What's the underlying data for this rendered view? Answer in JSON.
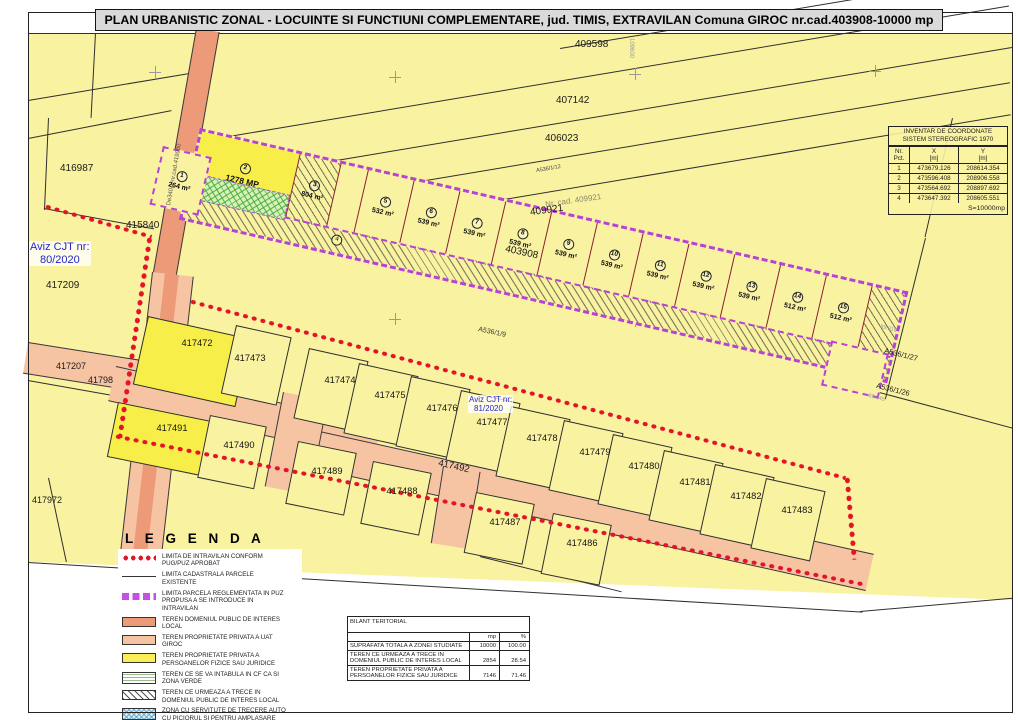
{
  "title": "PLAN URBANISTIC ZONAL - LOCUINTE SI FUNCTIUNI COMPLEMENTARE,  jud. TIMIS, EXTRAVILAN Comuna GIROC  nr.cad.403908-10000 mp",
  "coord_table": {
    "title1": "INVENTAR DE COORDONATE",
    "title2": "SISTEM STEREOGRAFIC 1970",
    "h_nr": "Nr. Pct.",
    "h_x": "X",
    "h_y": "Y",
    "unit": "[m]",
    "rows": [
      {
        "n": "1",
        "x": "473679.126",
        "y": "208614.354"
      },
      {
        "n": "2",
        "x": "473596.408",
        "y": "208906.558"
      },
      {
        "n": "3",
        "x": "473564.692",
        "y": "208897.692"
      },
      {
        "n": "4",
        "x": "473647.392",
        "y": "208605.551"
      }
    ],
    "footer": "S=10000mp"
  },
  "legend": {
    "title": "L E G E N D A",
    "items": [
      "LIMITA DE INTRAVILAN CONFORM PUG/PUZ APROBAT",
      "LIMITA CADASTRALA PARCELE EXISTENTE",
      "LIMITA PARCELA REGLEMENTATA IN PUZ PROPUSA A SE INTRODUCE IN INTRAVILAN",
      "TEREN DOMENIUL PUBLIC DE INTERES LOCAL",
      "TEREN PROPRIETATE PRIVATA A UAT GIROC",
      "TEREN PROPRIETATE PRIVATA A PERSOANELOR FIZICE SAU JURIDICE",
      "TEREN CE SE VA INTABULA IN CF CA SI ZONA VERDE",
      "TEREN CE URMEAZA A TRECE IN DOMENIUL PUBLIC DE INTERES LOCAL",
      "ZONA CU SERVITUTE DE TRECERE AUTO CU PICIORUL SI PENTRU AMPLASARE RETELE UTILITATI IN FAVOAREA PROPRIETARILOR PARCELELOR 5-14, PANA LA REALIZAREA CONTINUITATII DRUMURILOR PUBLICE"
    ]
  },
  "bilant": {
    "title": "BILANT TERITORIAL",
    "col_mp": "mp",
    "col_pct": "%",
    "rows": [
      {
        "label": "SUPRAFATA TOTALA A ZONEI STUDIATE",
        "mp": "10000",
        "pct": "100.00"
      },
      {
        "label": "TEREN CE URMEAZA A TRECE IN DOMENIUL PUBLIC DE INTERES LOCAL",
        "mp": "2854",
        "pct": "28.54"
      },
      {
        "label": "TEREN PROPRIETATE PRIVATA A PERSOANELOR FIZICE SAU JURIDICE",
        "mp": "7146",
        "pct": "71.46"
      }
    ]
  },
  "strip": {
    "parcels": [
      {
        "n": "1",
        "area": "264 m²"
      },
      {
        "n": "2",
        "area": "1278 MP"
      },
      {
        "n": "3",
        "area": "804 m²"
      },
      {
        "n": "4",
        "area": ""
      },
      {
        "n": "5",
        "area": "532 m²"
      },
      {
        "n": "6",
        "area": "539 m²"
      },
      {
        "n": "7",
        "area": "539 m²"
      },
      {
        "n": "8",
        "area": "539 m²"
      },
      {
        "n": "9",
        "area": "539 m²"
      },
      {
        "n": "10",
        "area": "539 m²"
      },
      {
        "n": "11",
        "area": "539 m²"
      },
      {
        "n": "12",
        "area": "539 m²"
      },
      {
        "n": "13",
        "area": "539 m²"
      },
      {
        "n": "14",
        "area": "512 m²"
      },
      {
        "n": "15",
        "area": "512 m²"
      }
    ]
  },
  "map_labels": {
    "p409598": "409598",
    "p407142": "407142",
    "p406023": "406023",
    "a536_1_12": "A536/1/12",
    "cad409921": "Nr. cad. 409921",
    "p409921": "409921",
    "grid": "109600",
    "cad403908": "403908",
    "a536_1_9": "A536/1/9",
    "a536_1_27": "A536/1/27",
    "a536_1_26": "A536/1/26",
    "dim1": "89.919",
    "dim2": "89.845",
    "p416987": "416987",
    "p415840": "415840",
    "p417209": "417209",
    "p417207": "417207",
    "p41798": "41798",
    "p417972": "417972",
    "road_de": "De340/1-nr.cad.419080",
    "road_492": "417492",
    "aviz80_1": "Aviz CJT nr:",
    "aviz80_2": "80/2020",
    "aviz81_1": "Aviz CJT nr:",
    "aviz81_2": "81/2020",
    "row1": [
      "417472",
      "417473",
      "417474",
      "417475",
      "417476",
      "417477",
      "417478",
      "417479",
      "417480",
      "417481",
      "417482",
      "417483"
    ],
    "row2": [
      "417491",
      "417490",
      "417489",
      "417488",
      "417487",
      "417486"
    ]
  },
  "colors": {
    "map_yellow": "#f9f2a0",
    "bright_yellow": "#f7ee49",
    "road_salmon": "#f6c4a2",
    "road_orange": "#ec9a78",
    "intravilan_red": "#e41428",
    "puz_purple": "#b841d6",
    "aviz_blue": "#2626cc"
  }
}
